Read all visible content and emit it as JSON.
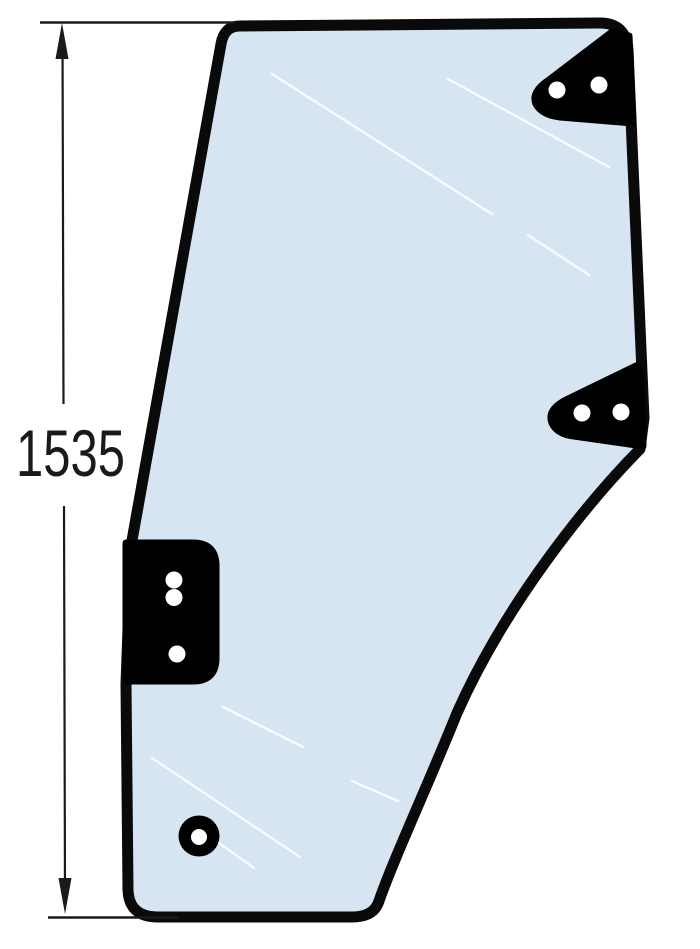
{
  "figure": {
    "type": "technical-drawing-door-glass",
    "dimension_label": "1535",
    "colors": {
      "background": "#ffffff",
      "glass": "#d7e5f3",
      "outline": "#0a0a0a",
      "bracket": "#000000",
      "hole": "#ffffff",
      "glare": "#ffffff",
      "dimension": "#1a1a1a"
    }
  }
}
